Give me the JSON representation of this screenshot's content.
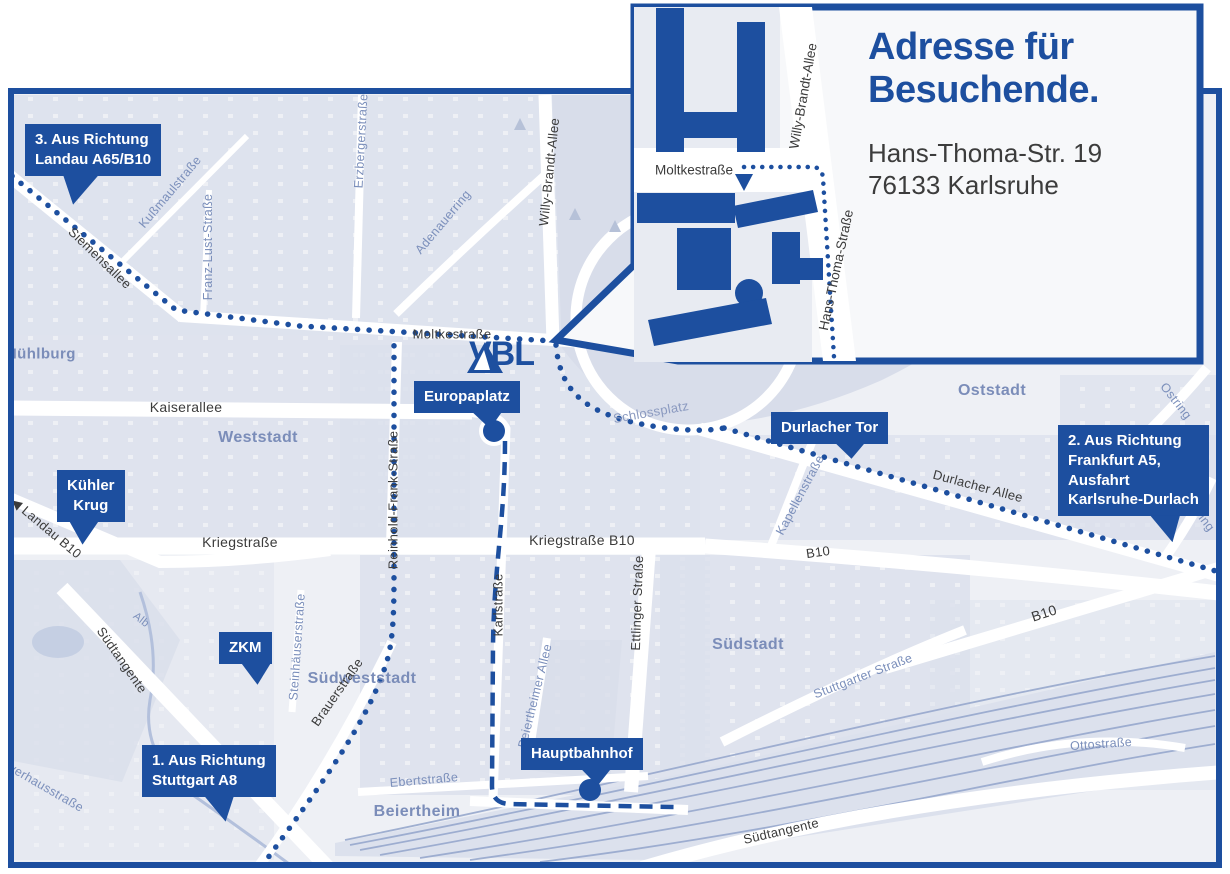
{
  "inset": {
    "title": [
      "Adresse für",
      "Besuchende."
    ],
    "address": [
      "Hans-Thoma-Str. 19",
      "76133 Karlsruhe"
    ],
    "streets": {
      "moltkestrasse": "Moltkestraße",
      "willy_brandt_allee": "Willy-Brandt-Allee",
      "hans_thoma_strasse": "Hans-Thoma-Straße"
    }
  },
  "logo": {
    "text": "VBL"
  },
  "callouts": {
    "landau": [
      "3. Aus Richtung",
      "Landau A65/B10"
    ],
    "frankfurt": [
      "2. Aus Richtung",
      "Frankfurt A5,",
      "Ausfahrt",
      "Karlsruhe-Durlach"
    ],
    "stuttgart": [
      "1. Aus Richtung",
      "Stuttgart A8"
    ],
    "kuehler_krug": [
      "Kühler",
      "Krug"
    ],
    "zkm": "ZKM",
    "europaplatz": "Europaplatz",
    "durlacher_tor": "Durlacher Tor",
    "hauptbahnhof": "Hauptbahnhof"
  },
  "districts": {
    "muehlburg": "Mühlburg",
    "weststadt": "Weststadt",
    "oststadt": "Oststadt",
    "suedstadt": "Südstadt",
    "suedweststadt": "Südweststadt",
    "beiertheim": "Beiertheim"
  },
  "streets": {
    "siemensallee": "Siemensallee",
    "kussmaulstrasse": "Kußmaulstraße",
    "franz_lust_strasse": "Franz-Lust-Straße",
    "erzbergerstrasse": "Erzbergerstraße",
    "adenauerring": "Adenauerring",
    "willy_brandt_allee": "Willy-Brandt-Allee",
    "moltkestrasse": "Moltkestraße",
    "kaiserallee": "Kaiserallee",
    "reinhold_frank_strasse": "Reinhold-Frank-Straße",
    "kriegstrasse": "Kriegstraße",
    "kriegstrasse_b10": "Kriegstraße B10",
    "karlstrasse": "Karlstraße",
    "ettlinger_strasse": "Ettlinger Straße",
    "schlossplatz": "Schlossplatz",
    "durlacher_allee": "Durlacher Allee",
    "kapellenstrasse": "Kapellenstraße",
    "b10": "B10",
    "landau_b10": "◀ Landau B10",
    "suedtangente": "Südtangente",
    "alb": "Alb",
    "brauerstrasse": "Brauerstraße",
    "steinhaeuserstrasse": "Steinhäuserstraße",
    "ebertstrasse": "Ebertstraße",
    "beiertheimer_allee": "Beiertheimer Allee",
    "stuttgarter_strasse": "Stuttgarter Straße",
    "ostring": "Ostring",
    "ottostrasse": "Ottostraße",
    "pulverhausstrasse": "Pulverhausstraße"
  },
  "colors": {
    "brand_blue": "#1d4f9f",
    "street_dark": "#3b3b3b",
    "street_blue": "#7b8fbb",
    "district_blue": "#7b8db9"
  }
}
